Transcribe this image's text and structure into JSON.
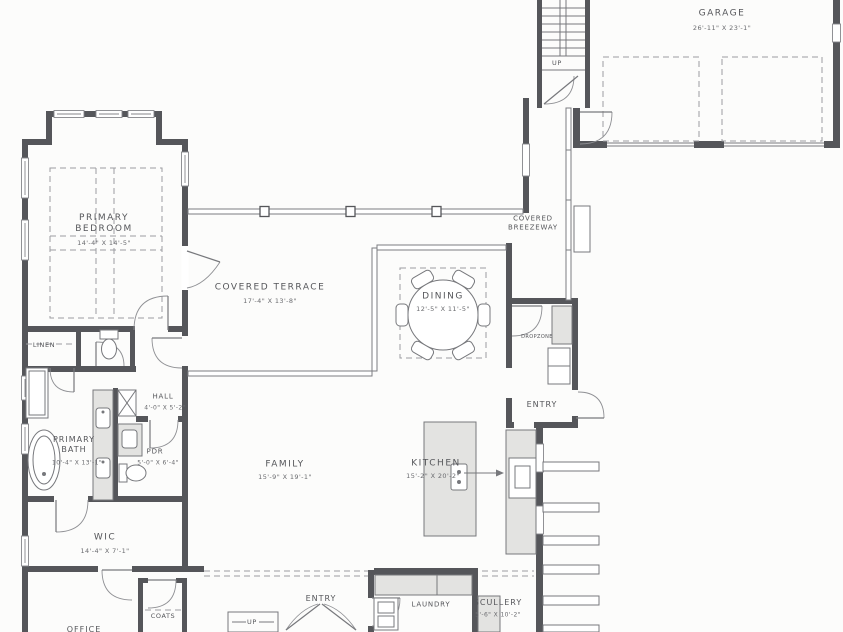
{
  "drawing": {
    "type": "residential floor plan"
  },
  "colors": {
    "wall": "#55565a",
    "thin_line": "#77787c",
    "dash": "#9b9ca0",
    "counter_fill": "#e3e3e1",
    "text": "#55565a"
  },
  "rooms": {
    "garage": {
      "label": "GARAGE",
      "dims": "26'-11\" X 23'-1\""
    },
    "primary_bedroom": {
      "label": "PRIMARY BEDROOM",
      "dims": "14'-4\" X 14'-5\""
    },
    "covered_terrace": {
      "label": "COVERED TERRACE",
      "dims": "17'-4\" X 13'-8\""
    },
    "covered_breezeway": {
      "label": "COVERED BREEZEWAY"
    },
    "dining": {
      "label": "DINING",
      "dims": "12'-5\" X 11'-5\""
    },
    "kitchen": {
      "label": "KITCHEN",
      "dims": "15'-2\" X 20'-2\""
    },
    "family": {
      "label": "FAMILY",
      "dims": "15'-9\" X 19'-1\""
    },
    "linen": {
      "label": "LINEN"
    },
    "hall": {
      "label": "HALL",
      "dims": "4'-0\" X 5'-2\""
    },
    "primary_bath": {
      "label": "PRIMARY BATH",
      "dims": "10'-4\" X 13'-1\""
    },
    "pdr": {
      "label": "PDR",
      "dims": "5'-0\" X 6'-4\""
    },
    "wic": {
      "label": "WIC",
      "dims": "14'-4\" X 7'-1\""
    },
    "entry_side": {
      "label": "ENTRY"
    },
    "dropzone": {
      "label": "DROPZONE"
    },
    "entry_main": {
      "label": "ENTRY"
    },
    "laundry": {
      "label": "LAUNDRY"
    },
    "scullery": {
      "label": "SCULLERY",
      "dims": "5'-6\" X 10'-2\""
    },
    "office": {
      "label": "OFFICE"
    },
    "coats": {
      "label": "COATS"
    }
  },
  "annotations": {
    "up_upper": "UP",
    "up_lower": "UP"
  }
}
